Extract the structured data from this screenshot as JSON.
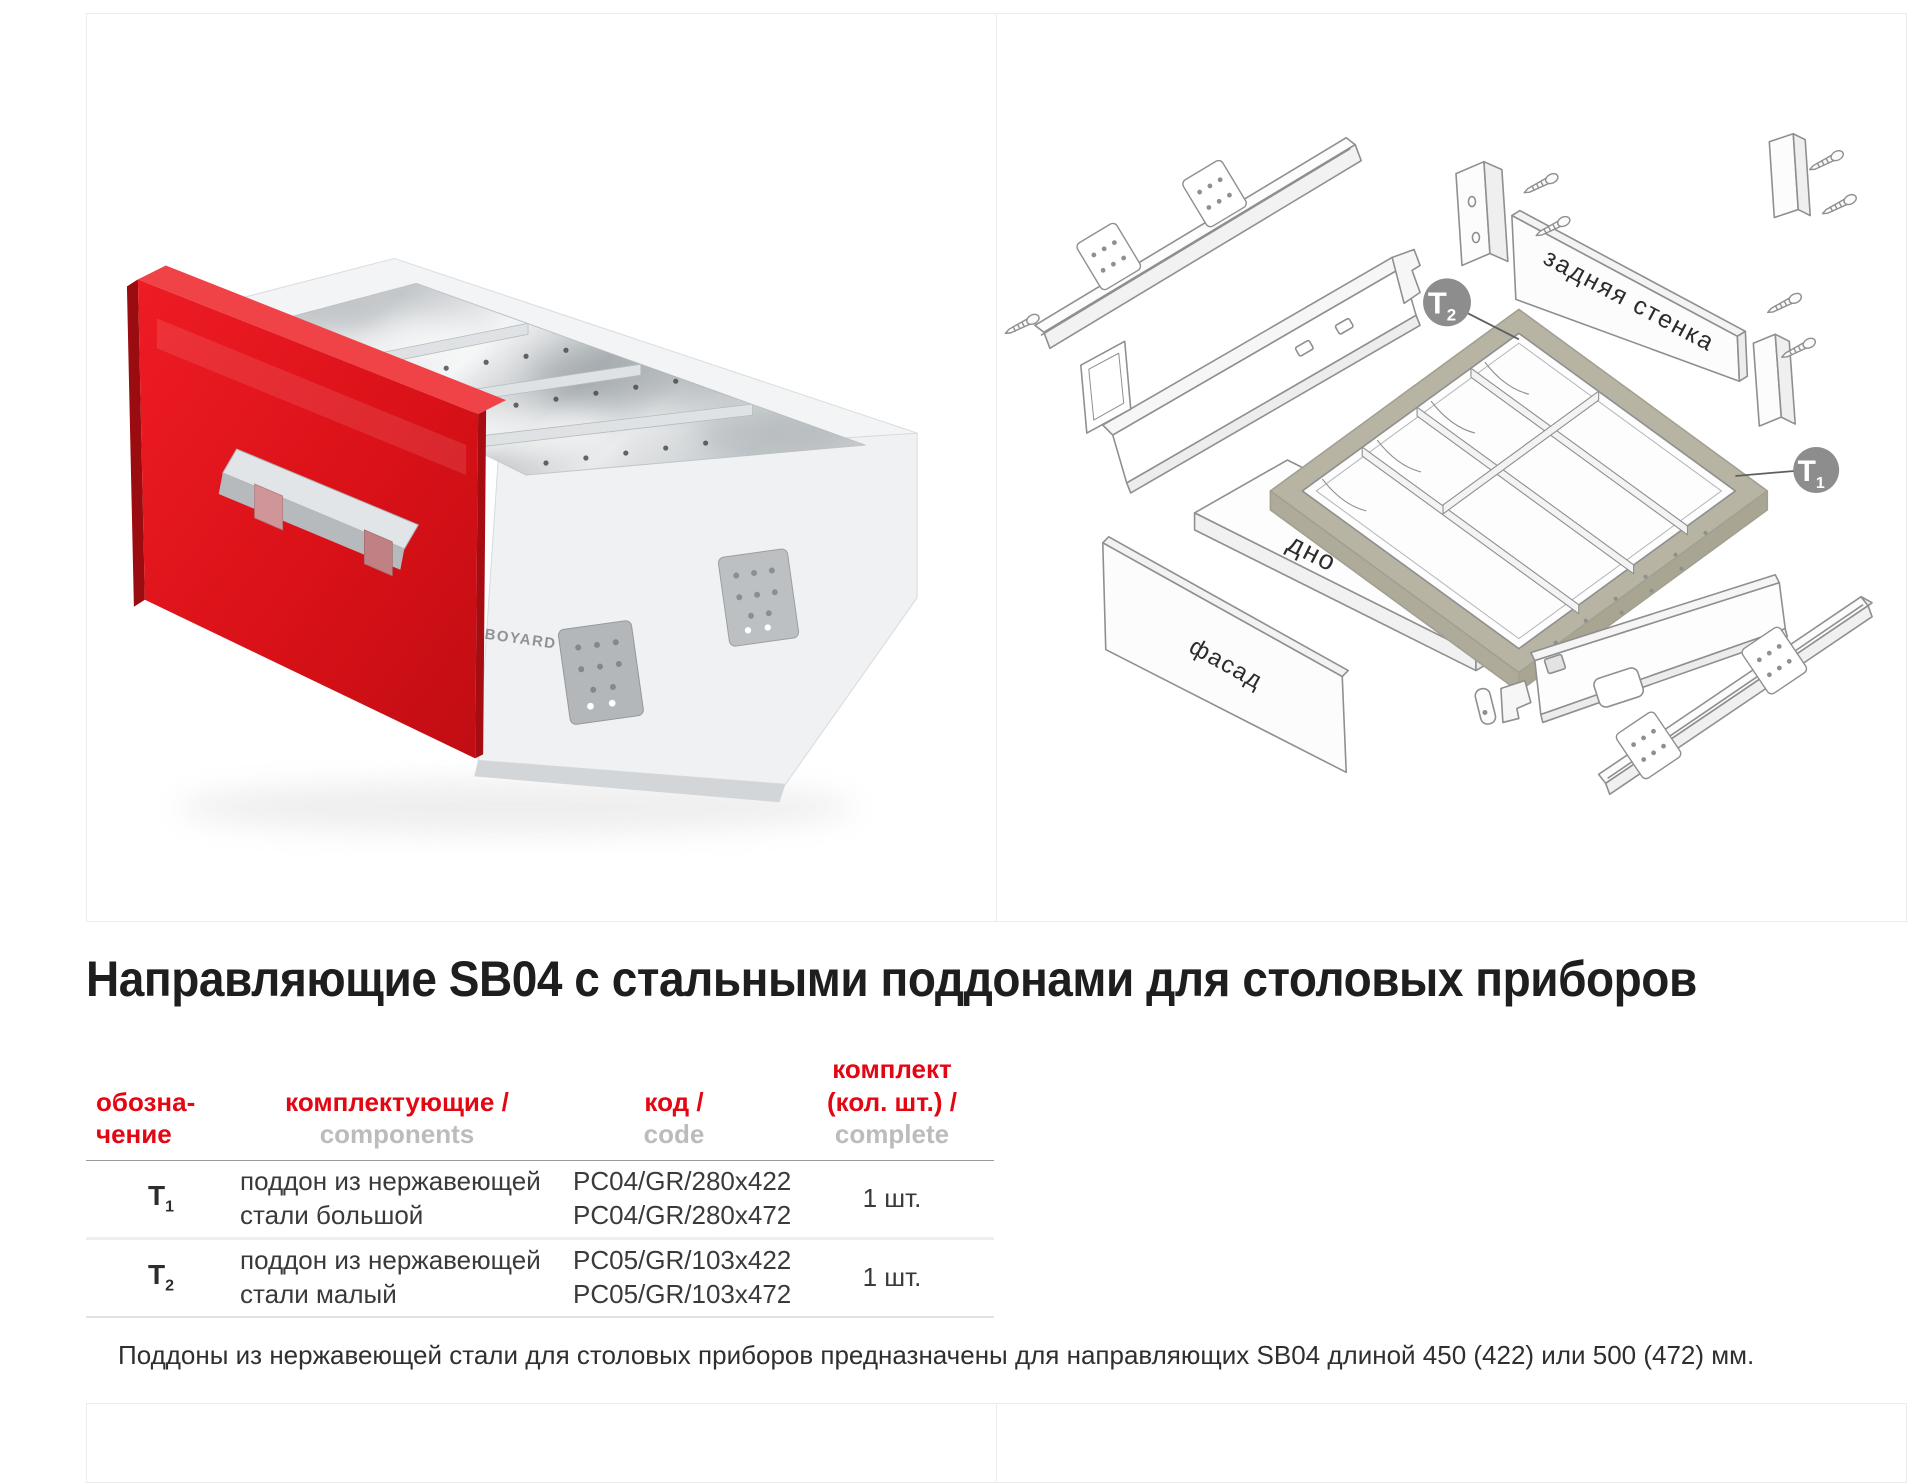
{
  "colors": {
    "accent_red": "#e30613",
    "heading_dark": "#1e1e1e",
    "muted_gray": "#bcbcbc",
    "panel_border": "#ececec",
    "olive_frame": "#b7b4a3",
    "callout_gray": "#8d8d8d",
    "drawer_red": "#da1118"
  },
  "photo": {
    "logo": "BOYARD"
  },
  "diagram": {
    "back_wall": "задняя стенка",
    "bottom": "дно",
    "facade": "фасад",
    "t1": {
      "label": "T",
      "sub": "1"
    },
    "t2": {
      "label": "T",
      "sub": "2"
    }
  },
  "heading": "Направляющие SB04 с стальными поддонами для столовых приборов",
  "table": {
    "col1": {
      "ru_line1": "обозна-",
      "ru_line2": "чение"
    },
    "col2": {
      "ru": "комплектующие /",
      "en": "components"
    },
    "col3": {
      "ru": "код /",
      "en": "code"
    },
    "col4": {
      "ru_line1": "комплект",
      "ru_line2": "(кол. шт.) /",
      "en": "complete"
    },
    "rows": [
      {
        "t": "T",
        "sub": "1",
        "component_line1": "поддон из нержавеющей",
        "component_line2": "стали большой",
        "code_line1": "PC04/GR/280x422",
        "code_line2": "PC04/GR/280x472",
        "qty": "1 шт."
      },
      {
        "t": "T",
        "sub": "2",
        "component_line1": "поддон из нержавеющей",
        "component_line2": "стали малый",
        "code_line1": "PC05/GR/103x422",
        "code_line2": "PC05/GR/103x472",
        "qty": "1 шт."
      }
    ]
  },
  "note": "Поддоны из нержавеющей стали для столовых приборов предназначены для направляющих SB04 длиной 450 (422) или 500 (472) мм."
}
